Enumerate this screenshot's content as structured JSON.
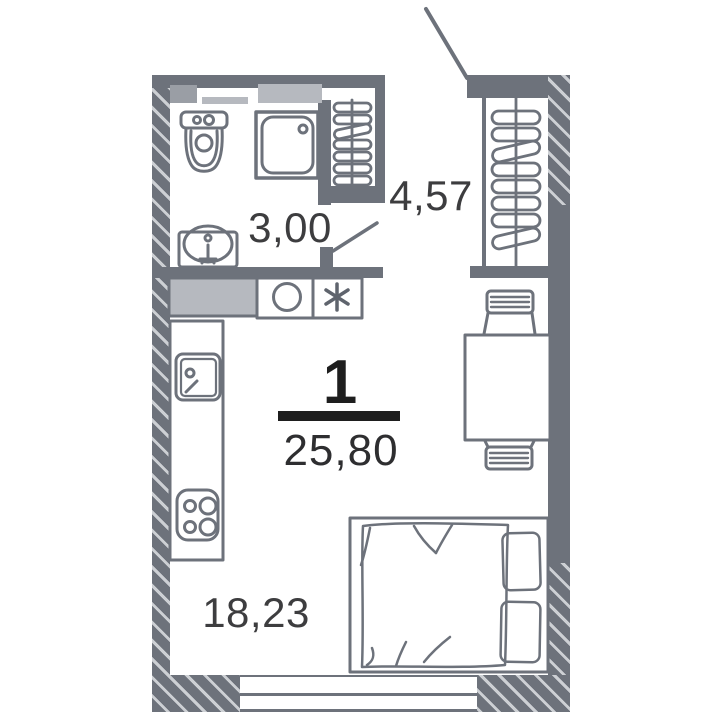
{
  "plan": {
    "title": "studio-apartment-floor-plan",
    "apartment": {
      "rooms_count": "1",
      "total_area": "25,80"
    },
    "rooms": [
      {
        "id": "bathroom",
        "area": "3,00"
      },
      {
        "id": "hallway",
        "area": "4,57"
      },
      {
        "id": "living-room",
        "area": "18,23"
      }
    ],
    "colors": {
      "wall": "#6d727b",
      "hatch_stripe": "#cdd0d4",
      "fill_light_gray": "#b6b9bf",
      "fill_medium_gray": "#9a9ea5",
      "label_text": "#3d3d3f",
      "fraction_text": "#1e1e1e",
      "background": "#ffffff"
    },
    "fixtures": [
      "toilet",
      "shower-cabin",
      "washbasin",
      "towel-radiator",
      "wardrobe-hangers",
      "kitchen-countertop",
      "washing-machine",
      "boiler-unit",
      "kitchen-sink",
      "stove",
      "dining-table",
      "chair",
      "double-bed",
      "pillow",
      "blanket",
      "window",
      "entrance-door-swing",
      "bathroom-door-swing"
    ]
  }
}
